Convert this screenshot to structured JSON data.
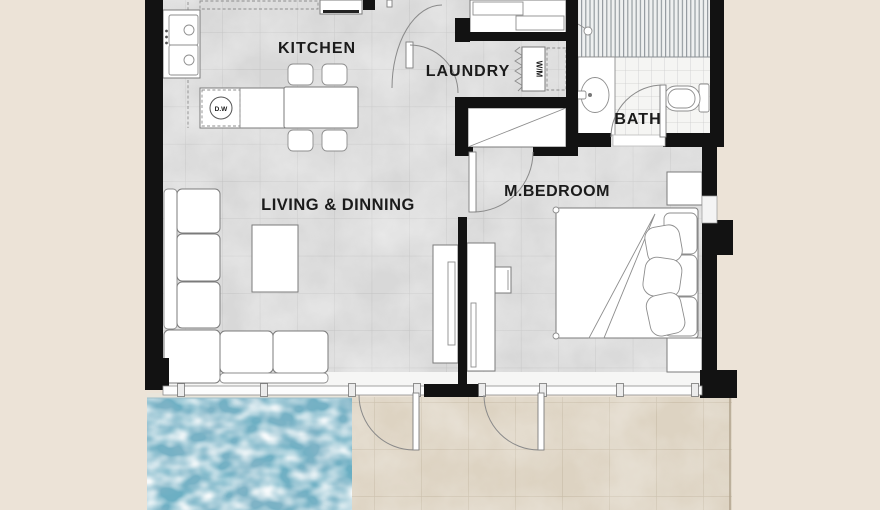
{
  "rooms": {
    "kitchen": {
      "label": "KITCHEN"
    },
    "laundry": {
      "label": "LAUNDRY"
    },
    "bath": {
      "label": "BATH"
    },
    "living_dining": {
      "label": "LIVING & DINNING"
    },
    "master_bedroom": {
      "label": "M.BEDROOM"
    }
  },
  "appliances": {
    "dishwasher": {
      "label": "D.W"
    },
    "washing_machine": {
      "label": "W/M"
    }
  },
  "colors": {
    "background": "#ece3d7",
    "wall": "#121212",
    "interior_floor": "#d8d8d8",
    "floor_grid": "#c2c2c2",
    "bath_floor": "#f5f5f3",
    "terrace_tile": "#ddd3c2",
    "terrace_grid": "#c7bba6",
    "pool_water": "#7fb3c6",
    "pool_dark": "#38758d",
    "pool_foam": "#ecf4f6",
    "furniture_fill": "#ffffff",
    "furniture_stroke": "#7b7b7b",
    "label_text": "#1b1b1b"
  }
}
